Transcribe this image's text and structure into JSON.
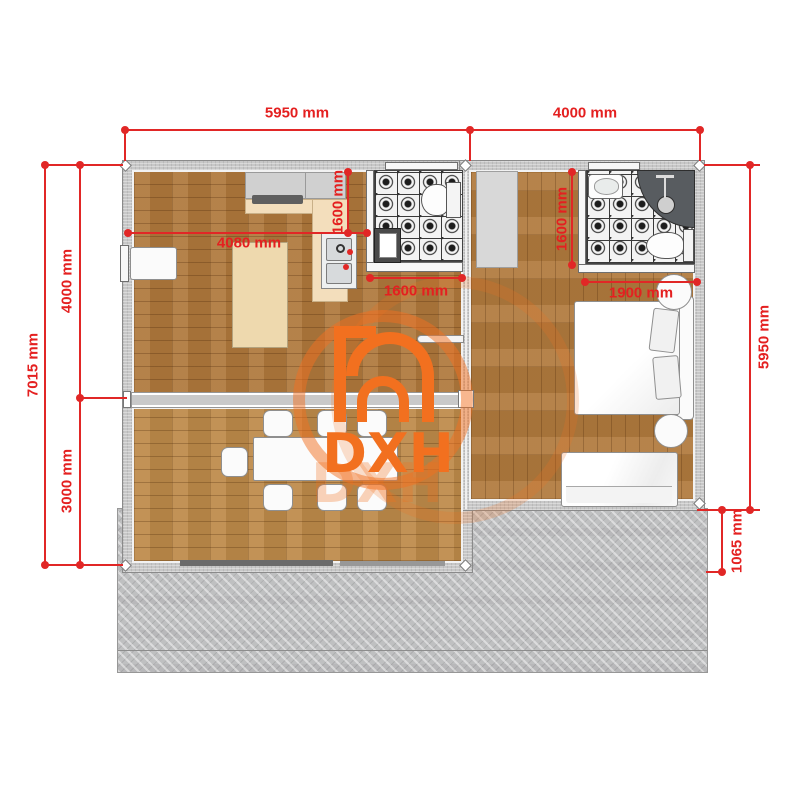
{
  "logo": {
    "text": "DXH",
    "color": "#f2701f"
  },
  "dimensions": {
    "top_left_width": "5950 mm",
    "top_right_width": "4000 mm",
    "left_total_height": "7015 mm",
    "left_upper_height": "4000 mm",
    "left_lower_height": "3000 mm",
    "right_main_height": "5950 mm",
    "right_patio_height": "1065 mm",
    "living_room_width": "4080 mm",
    "kitchen_run_height": "1600 mm",
    "bathroom1_width": "1600 mm",
    "bathroom2_height": "1600 mm",
    "bed_area_width": "1900 mm"
  },
  "colors": {
    "dimension_red": "#e12726",
    "logo_orange": "#f2701f",
    "floor_wood": "#af783c",
    "floor_wood_light": "#bd8a49",
    "tile_base": "#f3f3f3",
    "wall_gray": "#c7c7c7",
    "concrete_gray": "#bfc0c1",
    "counter_beige": "#f3debc"
  }
}
